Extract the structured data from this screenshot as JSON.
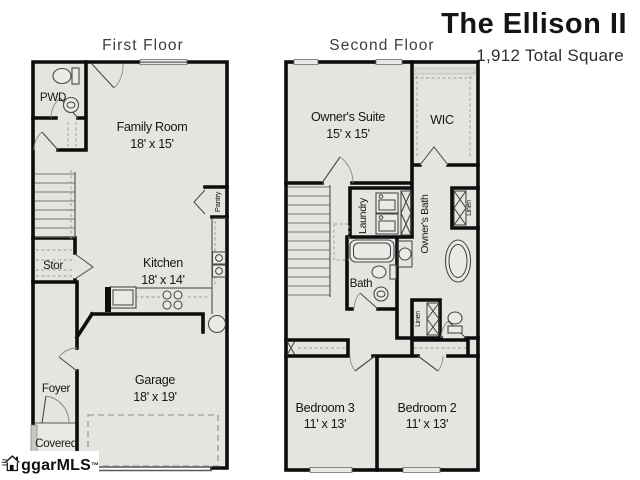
{
  "header": {
    "title": "The Ellison II",
    "subtitle": "1,912 Total Square"
  },
  "floors": {
    "first": {
      "label": "First Floor",
      "rooms": {
        "pwd": {
          "name": "PWD"
        },
        "family": {
          "name": "Family Room",
          "dims": "18' x 15'"
        },
        "stor": {
          "name": "Stor"
        },
        "kitchen": {
          "name": "Kitchen",
          "dims": "18' x 14'"
        },
        "pantry": {
          "name": "Pantry"
        },
        "foyer": {
          "name": "Foyer"
        },
        "garage": {
          "name": "Garage",
          "dims": "18' x 19'"
        },
        "covered": {
          "name": "Covered"
        }
      }
    },
    "second": {
      "label": "Second Floor",
      "rooms": {
        "owners_suite": {
          "name": "Owner's Suite",
          "dims": "15' x 15'"
        },
        "wic": {
          "name": "WIC"
        },
        "laundry": {
          "name": "Laundry"
        },
        "owners_bath": {
          "name": "Owner's Bath"
        },
        "linen_upper": {
          "name": "Linen"
        },
        "bath": {
          "name": "Bath"
        },
        "linen_hall": {
          "name": "Linen"
        },
        "bedroom3": {
          "name": "Bedroom 3",
          "dims": "11' x 13'"
        },
        "bedroom2": {
          "name": "Bedroom 2",
          "dims": "11' x 13'"
        }
      }
    }
  },
  "watermark": {
    "text": "ggarMLS",
    "tm": "™"
  },
  "colors": {
    "wall": "#0d0d0d",
    "floor_fill": "#e3e5df",
    "window_fill": "#e7e9e4",
    "dashed_line": "#8c8c8c",
    "title_text": "#141414",
    "floor_label_text": "#3d3d3d",
    "room_label_text": "#161616"
  }
}
